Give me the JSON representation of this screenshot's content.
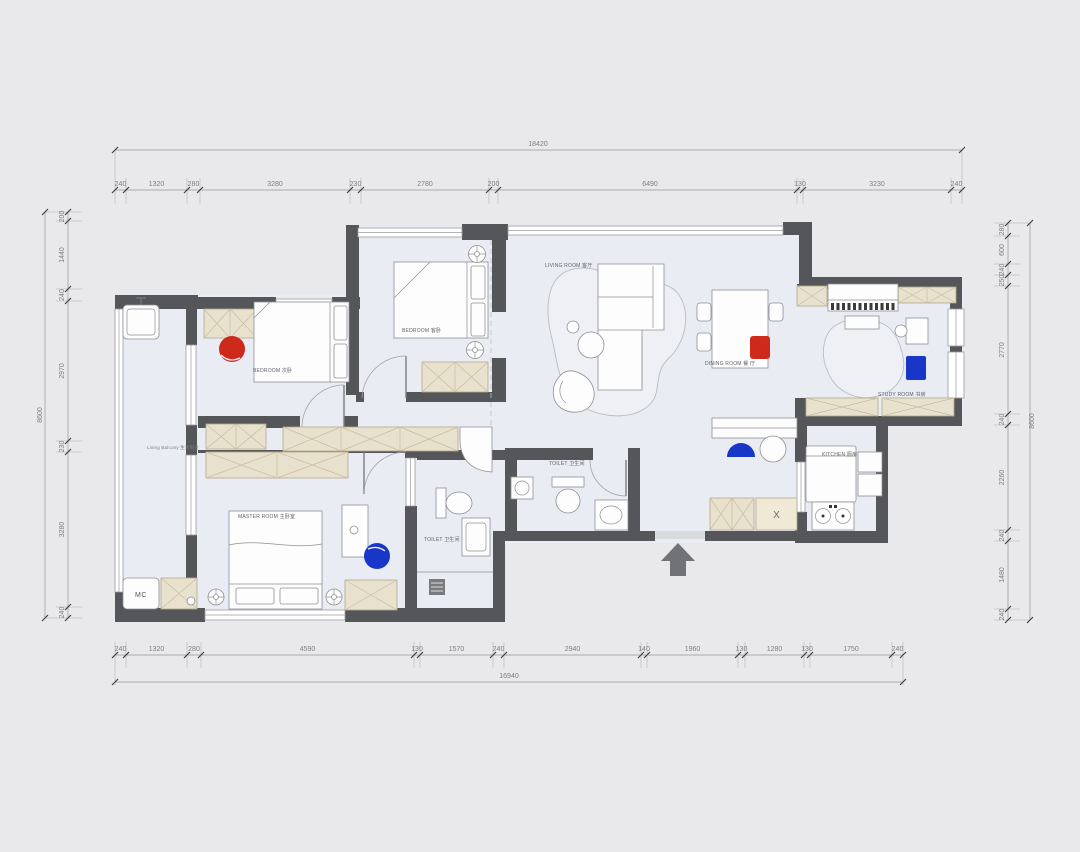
{
  "dims": {
    "top": {
      "total": "18420",
      "segments": [
        "240",
        "1320",
        "280",
        "3280",
        "230",
        "2780",
        "200",
        "6490",
        "130",
        "3230",
        "240"
      ]
    },
    "bottom": {
      "total": "16940",
      "segments": [
        "240",
        "1320",
        "280",
        "4590",
        "130",
        "1570",
        "240",
        "2940",
        "140",
        "1960",
        "130",
        "1280",
        "130",
        "1750",
        "240"
      ]
    },
    "left": {
      "total": "8600",
      "segments": [
        "200",
        "1440",
        "240",
        "2970",
        "230",
        "3280",
        "240"
      ]
    },
    "right": {
      "total": "8600",
      "segments": [
        "280",
        "600",
        "240",
        "250",
        "2770",
        "240",
        "2260",
        "240",
        "1480",
        "240"
      ]
    }
  },
  "rooms": {
    "living_balcony": "Living Balcony 生活阳台",
    "bedroom_left": "BEDROOM 次卧",
    "bedroom_top": "BEDROOM 客卧",
    "living": "LIVING ROOM 客厅",
    "dining": "DINING ROOM 餐 厅",
    "study": "STUDY ROOM 书房",
    "kitchen": "KITCHEN 厨房",
    "master": "MASTER ROOM 主卧室",
    "toilet_master": "TOILET 卫生间",
    "toilet_guest": "TOILET 卫生间"
  },
  "markers": {
    "washing_machine": "MC",
    "fridge": "X"
  },
  "colors": {
    "accent_red": "#cd2a1c",
    "accent_blue": "#1837c9",
    "wall": "#55565a",
    "floor": "#e9ecf3",
    "cabinet": "#e8e1ce",
    "background": "#e9e9eb"
  }
}
